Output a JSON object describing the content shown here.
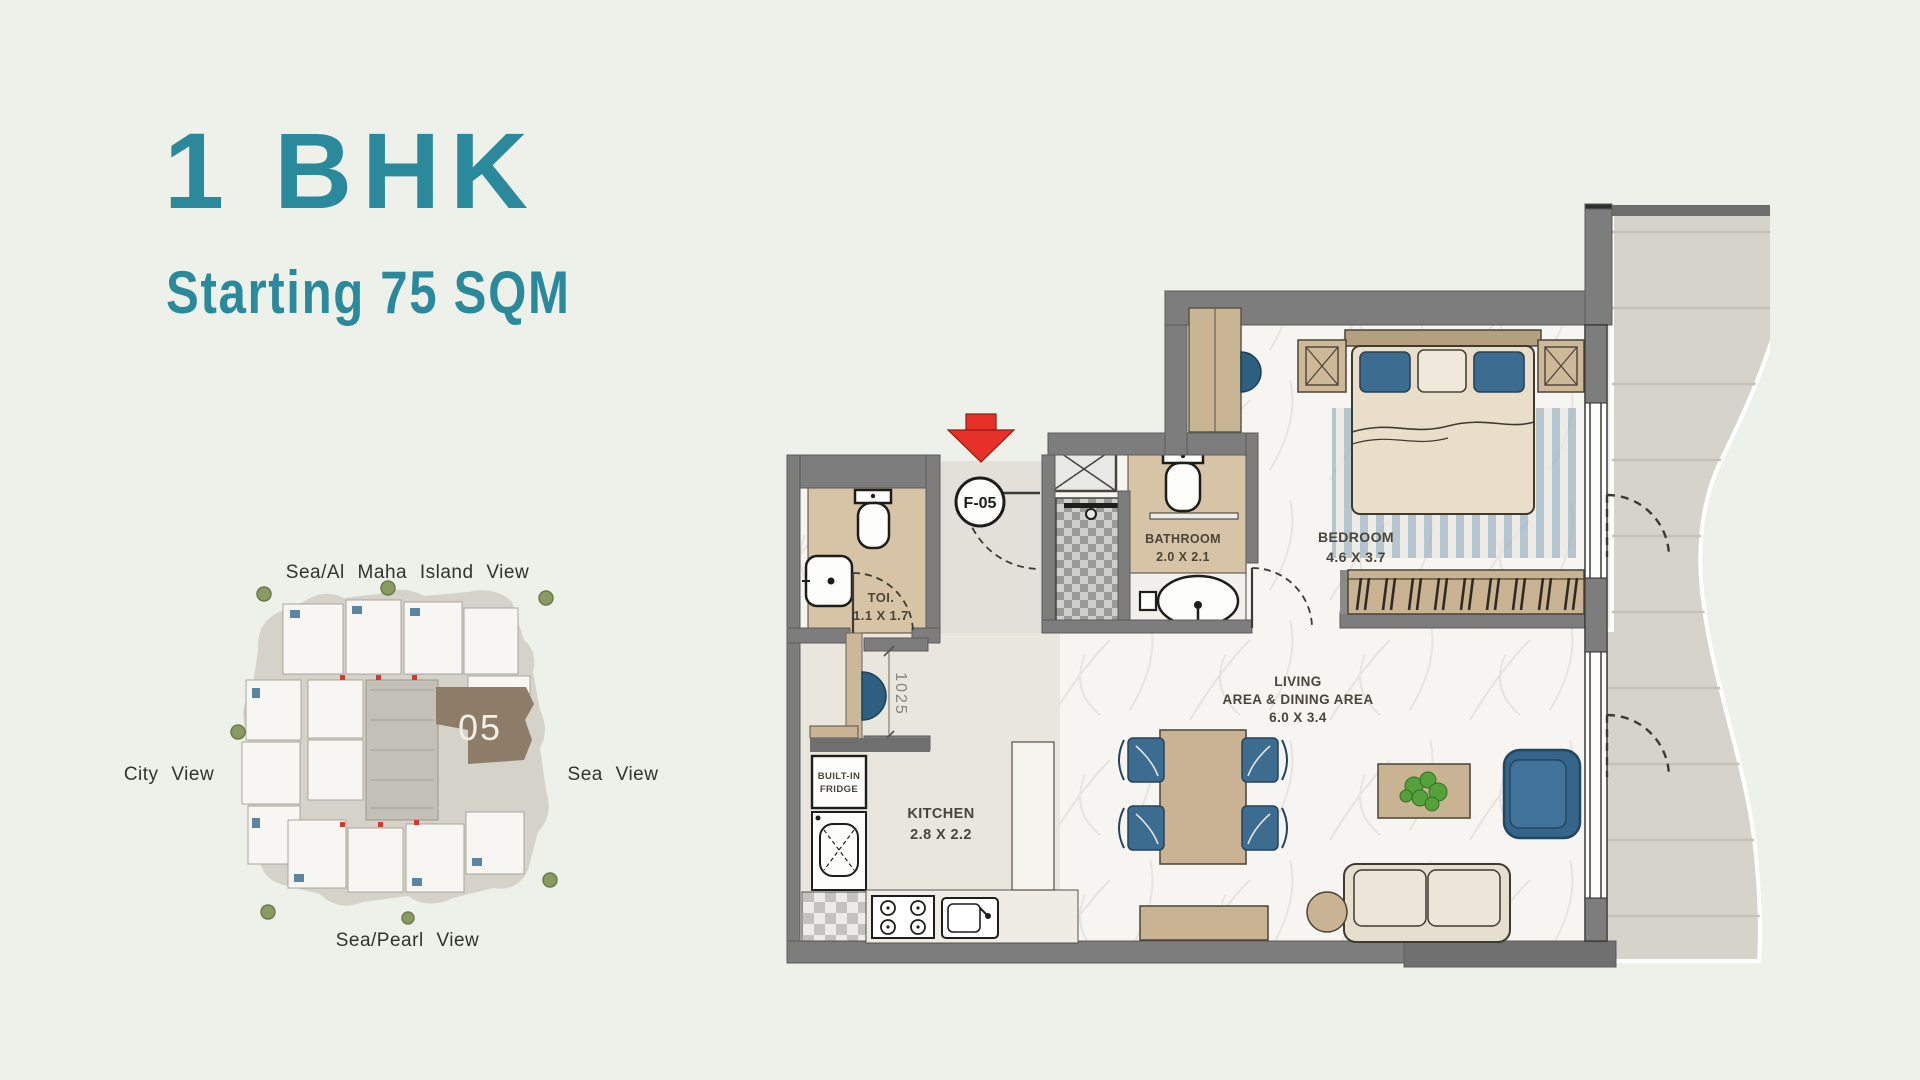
{
  "header": {
    "title": "1 BHK",
    "subtitle": "Starting 75 SQM"
  },
  "key_plan": {
    "unit_number": "05",
    "views": {
      "top": "Sea/Al Maha Island View",
      "left": "City View",
      "right": "Sea View",
      "bottom": "Sea/Pearl View"
    }
  },
  "floor_plan": {
    "entry_label": "F-05",
    "opening_dimension": "1025",
    "rooms": {
      "toi": {
        "name": "TOI.",
        "dim": "1.1 X 1.7"
      },
      "bathroom": {
        "name": "BATHROOM",
        "dim": "2.0 X 2.1"
      },
      "bedroom": {
        "name": "BEDROOM",
        "dim": "4.6 X 3.7"
      },
      "living": {
        "line1": "LIVING",
        "line2": "AREA & DINING AREA",
        "dim": "6.0 X 3.4"
      },
      "kitchen": {
        "name": "KITCHEN",
        "dim": "2.8 X 2.2"
      }
    },
    "fridge": {
      "line1": "BUILT-IN",
      "line2": "FRIDGE"
    }
  },
  "colors": {
    "accent_teal": "#2a8a9c",
    "background": "#eef0ea",
    "wall_gray": "#7d7d7d",
    "marble_tan": "#d7c4a6",
    "wood_tan": "#c9b392",
    "furniture_blue": "#3c6c8f",
    "terrace_stone": "#d6d3cb",
    "unit_highlight_brown": "#8c7c68",
    "entry_arrow_red": "#e53127"
  }
}
